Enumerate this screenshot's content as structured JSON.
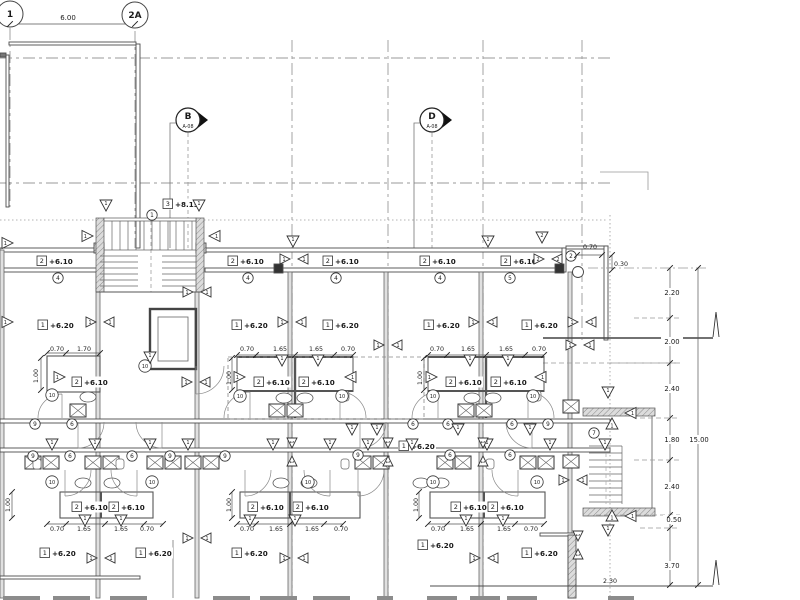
{
  "drawing": {
    "title": "architectural-floor-plan-level-+6.20",
    "colors": {
      "line": "#4d4d4d",
      "grid": "#9a9a9a",
      "text": "#1a1a1a",
      "wall_fill": "#c9c9c9",
      "arrow": "#111111"
    },
    "grid_bubbles": [
      {
        "label": "1",
        "x": 10,
        "y": 14
      },
      {
        "label": "2A",
        "x": 135,
        "y": 15
      }
    ],
    "top_dim": {
      "text": "6.00",
      "x": 68,
      "y": 20
    },
    "section_markers": [
      {
        "letter": "B",
        "sheet": "A-08",
        "x": 188,
        "y": 120
      },
      {
        "letter": "D",
        "sheet": "A-08",
        "x": 432,
        "y": 120
      }
    ],
    "level_labels": [
      {
        "box": "3",
        "text": "+8.15",
        "x": 163,
        "y": 207
      },
      {
        "box": "2",
        "text": "+6.10",
        "x": 37,
        "y": 264
      },
      {
        "box": "2",
        "text": "+6.10",
        "x": 228,
        "y": 264
      },
      {
        "box": "2",
        "text": "+6.10",
        "x": 323,
        "y": 264
      },
      {
        "box": "2",
        "text": "+6.10",
        "x": 420,
        "y": 264
      },
      {
        "box": "2",
        "text": "+6.10",
        "x": 501,
        "y": 264
      },
      {
        "box": "1",
        "text": "+6.20",
        "x": 38,
        "y": 328
      },
      {
        "box": "1",
        "text": "+6.20",
        "x": 232,
        "y": 328
      },
      {
        "box": "1",
        "text": "+6.20",
        "x": 323,
        "y": 328
      },
      {
        "box": "1",
        "text": "+6.20",
        "x": 424,
        "y": 328
      },
      {
        "box": "1",
        "text": "+6.20",
        "x": 522,
        "y": 328
      },
      {
        "box": "2",
        "text": "+6.10",
        "x": 72,
        "y": 385
      },
      {
        "box": "2",
        "text": "+6.10",
        "x": 254,
        "y": 385
      },
      {
        "box": "2",
        "text": "+6.10",
        "x": 299,
        "y": 385
      },
      {
        "box": "2",
        "text": "+6.10",
        "x": 446,
        "y": 385
      },
      {
        "box": "2",
        "text": "+6.10",
        "x": 491,
        "y": 385
      },
      {
        "box": "1",
        "text": "+6.20",
        "x": 399,
        "y": 449
      },
      {
        "box": "2",
        "text": "+6.10",
        "x": 72,
        "y": 510
      },
      {
        "box": "2",
        "text": "+6.10",
        "x": 109,
        "y": 510
      },
      {
        "box": "2",
        "text": "+6.10",
        "x": 248,
        "y": 510
      },
      {
        "box": "2",
        "text": "+6.10",
        "x": 293,
        "y": 510
      },
      {
        "box": "2",
        "text": "+6.10",
        "x": 451,
        "y": 510
      },
      {
        "box": "2",
        "text": "+6.10",
        "x": 488,
        "y": 510
      },
      {
        "box": "1",
        "text": "+6.20",
        "x": 40,
        "y": 556
      },
      {
        "box": "1",
        "text": "+6.20",
        "x": 136,
        "y": 556
      },
      {
        "box": "1",
        "text": "+6.20",
        "x": 232,
        "y": 556
      },
      {
        "box": "1",
        "text": "+6.20",
        "x": 418,
        "y": 548
      },
      {
        "box": "1",
        "text": "+6.20",
        "x": 522,
        "y": 556
      }
    ],
    "circled_numbers": [
      {
        "n": "1",
        "x": 152,
        "y": 215
      },
      {
        "n": "2",
        "x": 571,
        "y": 256
      },
      {
        "n": "4",
        "x": 58,
        "y": 278
      },
      {
        "n": "4",
        "x": 248,
        "y": 278
      },
      {
        "n": "4",
        "x": 336,
        "y": 278
      },
      {
        "n": "4",
        "x": 440,
        "y": 278
      },
      {
        "n": "5",
        "x": 510,
        "y": 278
      },
      {
        "n": "10",
        "x": 145,
        "y": 366
      },
      {
        "n": "10",
        "x": 52,
        "y": 395
      },
      {
        "n": "10",
        "x": 240,
        "y": 396
      },
      {
        "n": "10",
        "x": 342,
        "y": 396
      },
      {
        "n": "10",
        "x": 433,
        "y": 396
      },
      {
        "n": "10",
        "x": 533,
        "y": 396
      },
      {
        "n": "9",
        "x": 35,
        "y": 424
      },
      {
        "n": "6",
        "x": 72,
        "y": 424
      },
      {
        "n": "6",
        "x": 413,
        "y": 424
      },
      {
        "n": "6",
        "x": 448,
        "y": 424
      },
      {
        "n": "6",
        "x": 512,
        "y": 424
      },
      {
        "n": "9",
        "x": 548,
        "y": 424
      },
      {
        "n": "9",
        "x": 33,
        "y": 456
      },
      {
        "n": "6",
        "x": 70,
        "y": 456
      },
      {
        "n": "6",
        "x": 132,
        "y": 456
      },
      {
        "n": "9",
        "x": 170,
        "y": 456
      },
      {
        "n": "9",
        "x": 225,
        "y": 456
      },
      {
        "n": "9",
        "x": 358,
        "y": 455
      },
      {
        "n": "6",
        "x": 450,
        "y": 455
      },
      {
        "n": "6",
        "x": 510,
        "y": 455
      },
      {
        "n": "10",
        "x": 52,
        "y": 482
      },
      {
        "n": "10",
        "x": 152,
        "y": 482
      },
      {
        "n": "10",
        "x": 308,
        "y": 482
      },
      {
        "n": "10",
        "x": 433,
        "y": 482
      },
      {
        "n": "10",
        "x": 537,
        "y": 482
      },
      {
        "n": "7",
        "x": 594,
        "y": 433
      }
    ],
    "triangles": [
      {
        "d": "down",
        "n": "1",
        "x": 106,
        "y": 205
      },
      {
        "d": "down",
        "n": "1",
        "x": 199,
        "y": 205
      },
      {
        "d": "down",
        "n": "1",
        "x": 293,
        "y": 241
      },
      {
        "d": "down",
        "n": "1",
        "x": 488,
        "y": 241
      },
      {
        "d": "down",
        "n": "2",
        "x": 542,
        "y": 237
      },
      {
        "d": "down",
        "n": "1",
        "x": 150,
        "y": 357
      },
      {
        "d": "down",
        "n": "1",
        "x": 282,
        "y": 360
      },
      {
        "d": "down",
        "n": "1",
        "x": 318,
        "y": 360
      },
      {
        "d": "down",
        "n": "1",
        "x": 470,
        "y": 360
      },
      {
        "d": "down",
        "n": "1",
        "x": 508,
        "y": 360
      },
      {
        "d": "down",
        "n": "1",
        "x": 352,
        "y": 429
      },
      {
        "d": "down",
        "n": "1",
        "x": 377,
        "y": 429
      },
      {
        "d": "down",
        "n": "1",
        "x": 458,
        "y": 429
      },
      {
        "d": "down",
        "n": "1",
        "x": 530,
        "y": 429
      },
      {
        "d": "down",
        "n": "1",
        "x": 52,
        "y": 444
      },
      {
        "d": "down",
        "n": "1",
        "x": 95,
        "y": 444
      },
      {
        "d": "down",
        "n": "1",
        "x": 150,
        "y": 444
      },
      {
        "d": "down",
        "n": "1",
        "x": 188,
        "y": 444
      },
      {
        "d": "down",
        "n": "1",
        "x": 273,
        "y": 444
      },
      {
        "d": "down",
        "n": "1",
        "x": 330,
        "y": 444
      },
      {
        "d": "down",
        "n": "1",
        "x": 368,
        "y": 444
      },
      {
        "d": "down",
        "n": "1",
        "x": 412,
        "y": 444
      },
      {
        "d": "down",
        "n": "1",
        "x": 487,
        "y": 444
      },
      {
        "d": "down",
        "n": "1",
        "x": 550,
        "y": 444
      },
      {
        "d": "down",
        "n": "1",
        "x": 605,
        "y": 444
      },
      {
        "d": "down",
        "n": "1",
        "x": 85,
        "y": 520
      },
      {
        "d": "down",
        "n": "1",
        "x": 121,
        "y": 520
      },
      {
        "d": "down",
        "n": "1",
        "x": 250,
        "y": 520
      },
      {
        "d": "down",
        "n": "1",
        "x": 295,
        "y": 520
      },
      {
        "d": "down",
        "n": "1",
        "x": 466,
        "y": 520
      },
      {
        "d": "down",
        "n": "1",
        "x": 503,
        "y": 520
      },
      {
        "d": "down",
        "n": "1",
        "x": 608,
        "y": 392
      },
      {
        "d": "down",
        "n": "1",
        "x": 608,
        "y": 530
      },
      {
        "d": "up",
        "n": "1",
        "x": 612,
        "y": 424
      },
      {
        "d": "up",
        "n": "1",
        "x": 612,
        "y": 516
      },
      {
        "d": "right",
        "n": "1",
        "x": 60,
        "y": 377
      },
      {
        "d": "right",
        "n": "1",
        "x": 240,
        "y": 377
      },
      {
        "d": "right",
        "n": "1",
        "x": 432,
        "y": 377
      },
      {
        "d": "right",
        "n": "1",
        "x": 88,
        "y": 236
      },
      {
        "d": "right",
        "n": "1",
        "x": 8,
        "y": 322
      },
      {
        "d": "right",
        "n": "1",
        "x": 8,
        "y": 243
      },
      {
        "d": "left",
        "n": "1",
        "x": 350,
        "y": 377
      },
      {
        "d": "left",
        "n": "1",
        "x": 540,
        "y": 377
      },
      {
        "d": "left",
        "n": "1",
        "x": 214,
        "y": 236
      },
      {
        "d": "left",
        "n": "1",
        "x": 630,
        "y": 413
      },
      {
        "d": "left",
        "n": "1",
        "x": 630,
        "y": 516
      }
    ],
    "bowties": [
      {
        "x": 294,
        "y": 259,
        "n": "1",
        "v": false
      },
      {
        "x": 548,
        "y": 259,
        "n": "2",
        "v": false
      },
      {
        "x": 197,
        "y": 292,
        "n": "1",
        "v": false
      },
      {
        "x": 100,
        "y": 322,
        "n": "1",
        "v": false
      },
      {
        "x": 292,
        "y": 322,
        "n": "1",
        "v": false
      },
      {
        "x": 483,
        "y": 322,
        "n": "1",
        "v": false
      },
      {
        "x": 582,
        "y": 322,
        "n": "1",
        "v": false
      },
      {
        "x": 388,
        "y": 345,
        "n": "1",
        "v": false
      },
      {
        "x": 580,
        "y": 345,
        "n": "1",
        "v": false
      },
      {
        "x": 196,
        "y": 382,
        "n": "1",
        "v": false
      },
      {
        "x": 292,
        "y": 452,
        "n": "1",
        "v": true
      },
      {
        "x": 388,
        "y": 452,
        "n": "1",
        "v": true
      },
      {
        "x": 483,
        "y": 452,
        "n": "1",
        "v": true
      },
      {
        "x": 573,
        "y": 480,
        "n": "1",
        "v": false
      },
      {
        "x": 578,
        "y": 545,
        "n": "1",
        "v": true
      },
      {
        "x": 101,
        "y": 558,
        "n": "1",
        "v": false
      },
      {
        "x": 197,
        "y": 538,
        "n": "1",
        "v": false
      },
      {
        "x": 294,
        "y": 558,
        "n": "1",
        "v": false
      },
      {
        "x": 484,
        "y": 558,
        "n": "1",
        "v": false
      }
    ],
    "dim_texts": [
      {
        "text": "0.70",
        "x": 57,
        "y": 351
      },
      {
        "text": "1.70",
        "x": 84,
        "y": 351
      },
      {
        "text": "0.70",
        "x": 247,
        "y": 351
      },
      {
        "text": "1.65",
        "x": 280,
        "y": 351
      },
      {
        "text": "1.65",
        "x": 316,
        "y": 351
      },
      {
        "text": "0.70",
        "x": 348,
        "y": 351
      },
      {
        "text": "0.70",
        "x": 437,
        "y": 351
      },
      {
        "text": "1.65",
        "x": 468,
        "y": 351
      },
      {
        "text": "1.65",
        "x": 506,
        "y": 351
      },
      {
        "text": "0.70",
        "x": 539,
        "y": 351
      },
      {
        "text": "1.00",
        "x": 38,
        "y": 376,
        "rot": true
      },
      {
        "text": "1.00",
        "x": 231,
        "y": 378,
        "rot": true
      },
      {
        "text": "1.00",
        "x": 422,
        "y": 378,
        "rot": true
      },
      {
        "text": "0.70",
        "x": 590,
        "y": 249
      },
      {
        "text": "0.30",
        "x": 621,
        "y": 266
      },
      {
        "text": "1.00",
        "x": 10,
        "y": 505,
        "rot": true
      },
      {
        "text": "1.00",
        "x": 231,
        "y": 505,
        "rot": true
      },
      {
        "text": "1.00",
        "x": 418,
        "y": 505,
        "rot": true
      },
      {
        "text": "0.70",
        "x": 57,
        "y": 531
      },
      {
        "text": "1.65",
        "x": 84,
        "y": 531
      },
      {
        "text": "1.65",
        "x": 121,
        "y": 531
      },
      {
        "text": "0.70",
        "x": 147,
        "y": 531
      },
      {
        "text": "0.70",
        "x": 247,
        "y": 531
      },
      {
        "text": "1.65",
        "x": 276,
        "y": 531
      },
      {
        "text": "1.65",
        "x": 312,
        "y": 531
      },
      {
        "text": "0.70",
        "x": 341,
        "y": 531
      },
      {
        "text": "0.70",
        "x": 438,
        "y": 531
      },
      {
        "text": "1.65",
        "x": 467,
        "y": 531
      },
      {
        "text": "1.65",
        "x": 504,
        "y": 531
      },
      {
        "text": "0.70",
        "x": 531,
        "y": 531
      },
      {
        "text": "2.30",
        "x": 610,
        "y": 583
      }
    ],
    "right_chain": {
      "values": [
        {
          "text": "2.20",
          "x": 672,
          "y": 295
        },
        {
          "text": "2.00",
          "x": 672,
          "y": 344
        },
        {
          "text": "2.40",
          "x": 672,
          "y": 391
        },
        {
          "text": "1.80",
          "x": 672,
          "y": 442
        },
        {
          "text": "2.40",
          "x": 672,
          "y": 489
        },
        {
          "text": "0.50",
          "x": 674,
          "y": 522
        },
        {
          "text": "3.70",
          "x": 672,
          "y": 568
        }
      ],
      "overall": {
        "text": "15.00",
        "x": 699,
        "y": 442
      }
    },
    "fixtures": {
      "xboxes": [
        [
          70,
          404
        ],
        [
          269,
          404
        ],
        [
          287,
          404
        ],
        [
          458,
          404
        ],
        [
          476,
          404
        ],
        [
          25,
          456
        ],
        [
          43,
          456
        ],
        [
          85,
          456
        ],
        [
          103,
          456
        ],
        [
          147,
          456
        ],
        [
          165,
          456
        ],
        [
          185,
          456
        ],
        [
          203,
          456
        ],
        [
          355,
          456
        ],
        [
          373,
          456
        ],
        [
          437,
          456
        ],
        [
          455,
          456
        ],
        [
          520,
          456
        ],
        [
          538,
          456
        ],
        [
          563,
          400
        ],
        [
          563,
          455
        ]
      ],
      "wcs": [
        [
          88,
          397
        ],
        [
          284,
          398
        ],
        [
          305,
          398
        ],
        [
          472,
          398
        ],
        [
          493,
          398
        ],
        [
          83,
          483
        ],
        [
          112,
          483
        ],
        [
          281,
          483
        ],
        [
          309,
          483
        ],
        [
          421,
          483
        ],
        [
          441,
          483
        ]
      ],
      "sinks": [
        [
          240,
          396
        ],
        [
          345,
          396
        ],
        [
          434,
          396
        ],
        [
          537,
          396
        ],
        [
          37,
          464
        ],
        [
          120,
          464
        ],
        [
          345,
          464
        ],
        [
          490,
          464
        ]
      ],
      "arcs": [
        [
          250,
          418,
          26,
          "ul"
        ],
        [
          340,
          418,
          26,
          "ur"
        ],
        [
          438,
          418,
          26,
          "ul"
        ],
        [
          528,
          418,
          26,
          "ur"
        ],
        [
          62,
          418,
          24,
          "ul"
        ],
        [
          196,
          366,
          28,
          "dr"
        ],
        [
          78,
          422,
          26,
          "dr"
        ],
        [
          162,
          422,
          26,
          "dl"
        ],
        [
          360,
          422,
          26,
          "dr"
        ],
        [
          532,
          422,
          26,
          "dl"
        ],
        [
          65,
          470,
          26,
          "dr"
        ],
        [
          137,
          470,
          26,
          "dl"
        ],
        [
          245,
          470,
          26,
          "dr"
        ],
        [
          330,
          470,
          26,
          "dl"
        ],
        [
          358,
          470,
          26,
          "dr"
        ],
        [
          518,
          470,
          26,
          "dl"
        ]
      ]
    }
  }
}
